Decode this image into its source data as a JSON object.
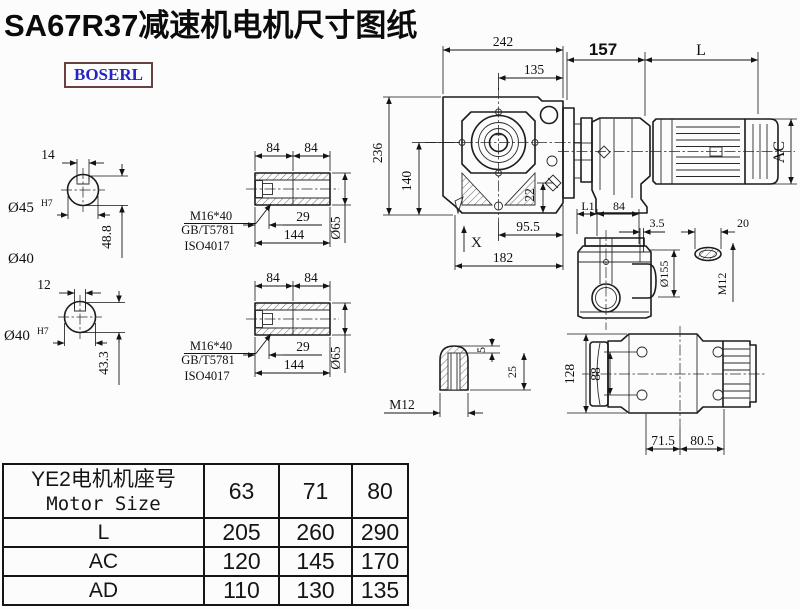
{
  "title": "SA67R37减速机电机尺寸图纸",
  "logo": "BOSERL",
  "colors": {
    "line": "#1c1c1c",
    "logo_text": "#2525c4",
    "logo_border": "#6b4040",
    "bg": "#fcfcfc"
  },
  "shaft_a": {
    "key_width": "14",
    "bore": "Ø45",
    "fit": "H7",
    "key_height": "48.8",
    "alt": "Ø40"
  },
  "shaft_b": {
    "key_width": "12",
    "bore": "Ø40",
    "fit": "H7",
    "key_height": "43.3"
  },
  "hollow_a": {
    "len1": "84",
    "len2": "84",
    "screw": "M16*40",
    "std1": "GB/T5781",
    "std2": "ISO4017",
    "depth": "29",
    "total": "144",
    "dia": "Ø65"
  },
  "hollow_b": {
    "len1": "84",
    "len2": "84",
    "screw": "M16*40",
    "std1": "GB/T5781",
    "std2": "ISO4017",
    "depth": "29",
    "total": "144",
    "dia": "Ø65"
  },
  "front": {
    "width": "242",
    "to_axis": "135",
    "height": "236",
    "axis_h": "140",
    "plug": "22",
    "foot": "95.5",
    "base": "182",
    "marker": "X"
  },
  "train": {
    "adapter": "157",
    "motor_len": "L",
    "motor_dia": "AC"
  },
  "sideview": {
    "l1": "L1",
    "flange": "84",
    "gap": "3.5",
    "dia": "Ø155",
    "slot_w": "20",
    "thread": "M12"
  },
  "keyslot": {
    "depth": "5",
    "len": "25",
    "thread": "M12"
  },
  "bottomview": {
    "height": "128",
    "bolt_span": "88",
    "left": "71.5",
    "right": "80.5"
  },
  "table": {
    "header_cn": "YE2电机机座号",
    "header_en": "Motor Size",
    "sizes": [
      "63",
      "71",
      "80"
    ],
    "rows": [
      {
        "label": "L",
        "values": [
          "205",
          "260",
          "290"
        ]
      },
      {
        "label": "AC",
        "values": [
          "120",
          "145",
          "170"
        ]
      },
      {
        "label": "AD",
        "values": [
          "110",
          "130",
          "135"
        ]
      }
    ]
  }
}
